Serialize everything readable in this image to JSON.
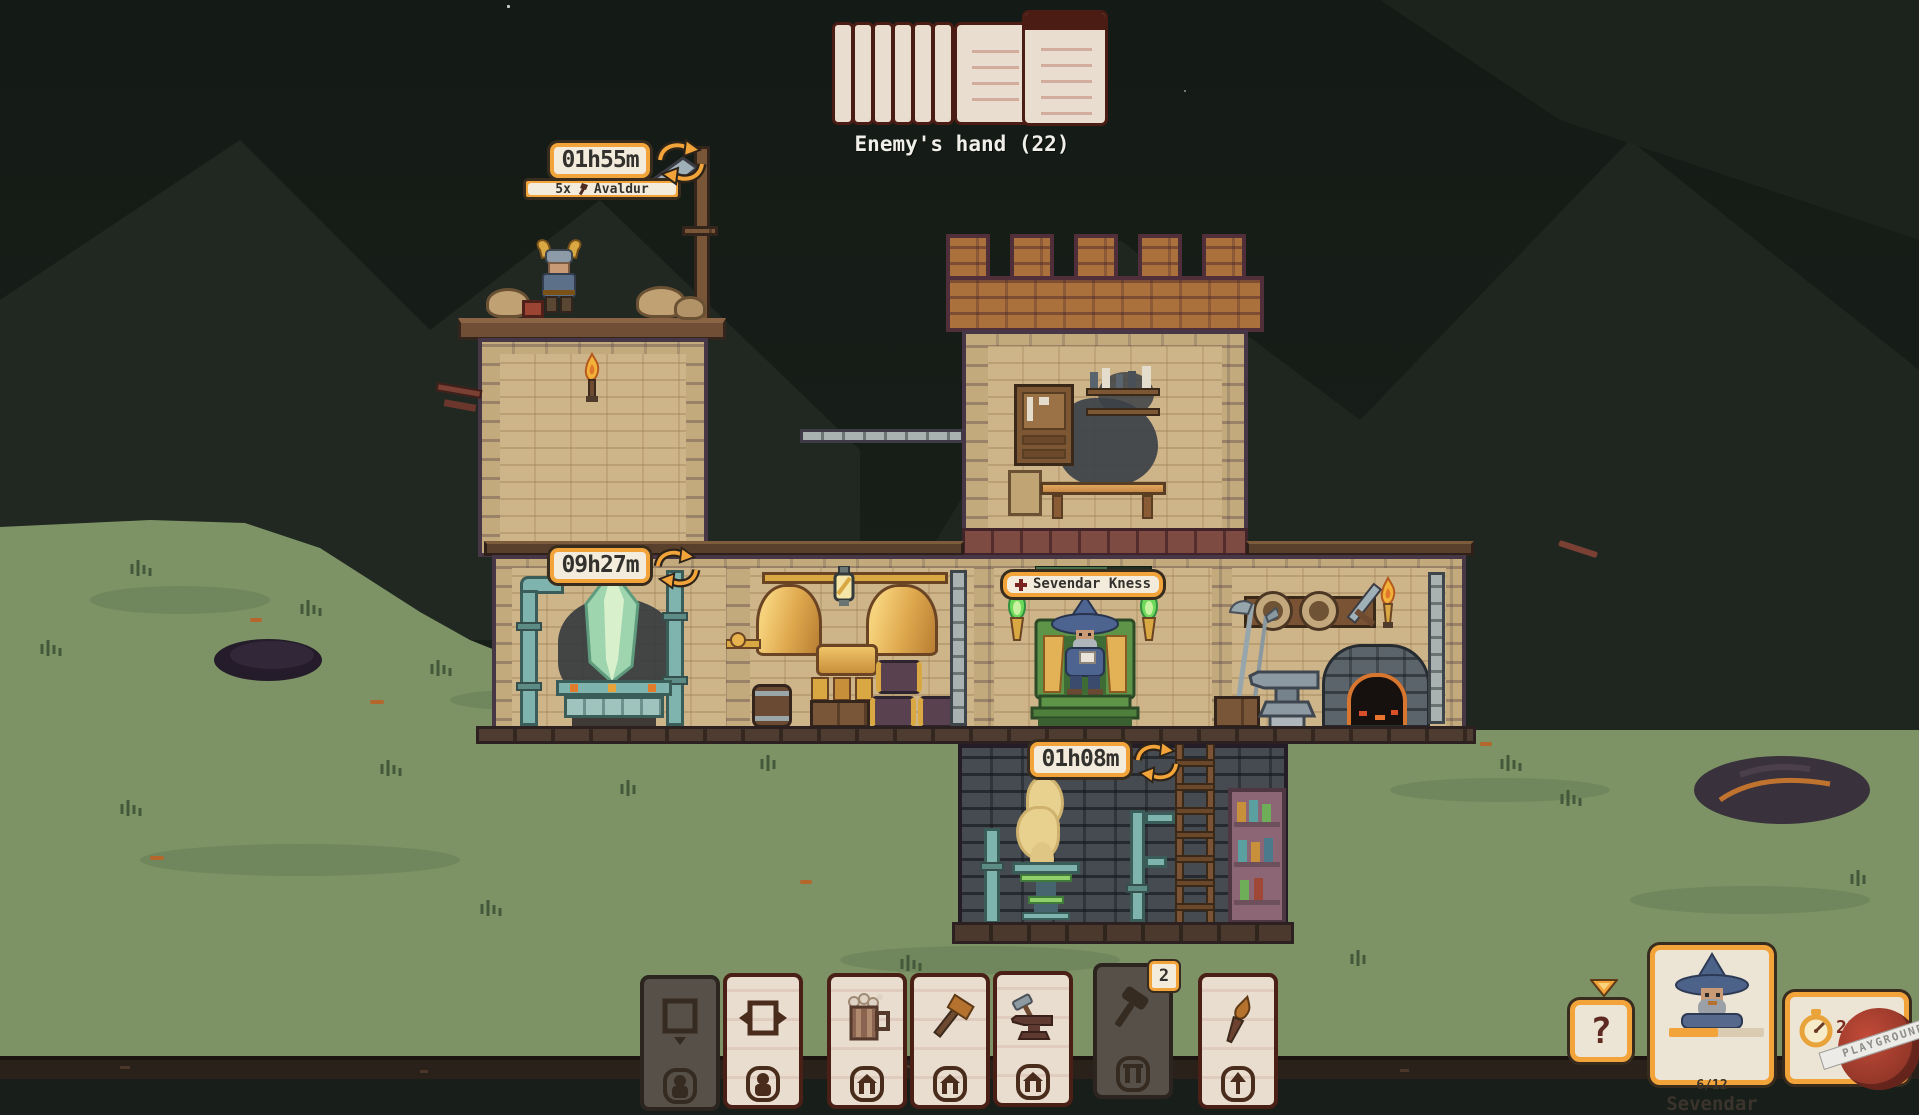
{
  "enemy": {
    "hand_label": "Enemy's hand (22)"
  },
  "timers": {
    "rooftop": {
      "time": "01h55m",
      "count": "5x",
      "unit": "Avaldur"
    },
    "crystal": {
      "time": "09h27m"
    },
    "basement": {
      "time": "01h08m"
    }
  },
  "throne": {
    "occupant": "Sevendar Kness"
  },
  "hand": {
    "cards": [
      {
        "name": "build-room",
        "icon": "room-frame-icon",
        "footer_icon": "person-icon",
        "disabled": true
      },
      {
        "name": "expand-room",
        "icon": "room-expand-icon",
        "footer_icon": "person-icon",
        "disabled": false
      },
      {
        "name": "beer",
        "icon": "beer-mug-icon",
        "footer_icon": "building-icon",
        "disabled": false
      },
      {
        "name": "axe",
        "icon": "axe-icon",
        "footer_icon": "building-icon",
        "disabled": false
      },
      {
        "name": "anvil",
        "icon": "anvil-icon",
        "footer_icon": "building-icon",
        "disabled": false
      },
      {
        "name": "mallet",
        "icon": "mallet-icon",
        "footer_icon": "pillars-icon",
        "disabled": true,
        "badge": "2"
      },
      {
        "name": "torch",
        "icon": "torch-icon",
        "footer_icon": "up-arrow-icon",
        "disabled": false
      }
    ]
  },
  "hud": {
    "help_label": "?",
    "character": {
      "name": "Sevendar",
      "hp": "6/12"
    },
    "clock": {
      "time": "21h17m",
      "day": "Day 4"
    }
  },
  "watermark": {
    "text": "PLAYGROUND"
  },
  "colors": {
    "accent_orange": "#f2a43a",
    "panel_cream": "#ece4d4",
    "card_face": "#e9ddcf",
    "card_border": "#4a1f16",
    "night_sky": "#181e19",
    "grass": "#7d9365"
  }
}
